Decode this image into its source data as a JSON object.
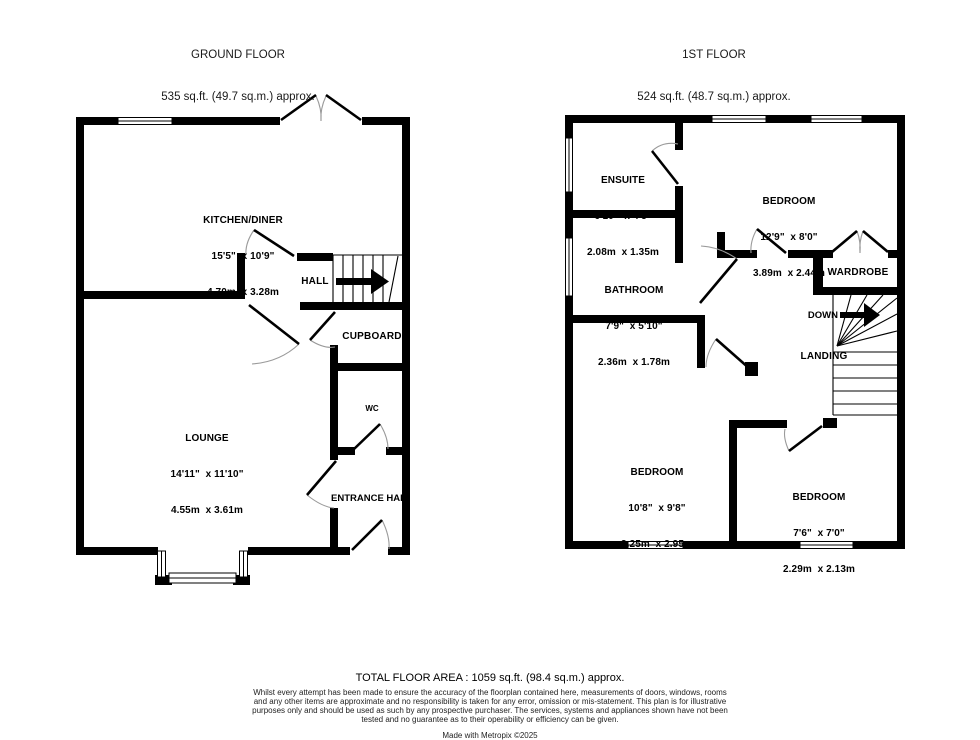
{
  "ground_floor": {
    "title": "GROUND FLOOR",
    "area": "535 sq.ft. (49.7 sq.m.) approx.",
    "kitchen": {
      "name": "KITCHEN/DINER",
      "imperial": "15'5\"  x 10'9\"",
      "metric": "4.70m  x 3.28m"
    },
    "lounge": {
      "name": "LOUNGE",
      "imperial": "14'11\"  x 11'10\"",
      "metric": "4.55m  x 3.61m"
    },
    "hall": "HALL",
    "cupboard": "CUPBOARD",
    "wc": "WC",
    "entrance_hall": "ENTRANCE HALL"
  },
  "first_floor": {
    "title": "1ST FLOOR",
    "area": "524 sq.ft. (48.7 sq.m.) approx.",
    "ensuite": {
      "name": "ENSUITE",
      "imperial": "6'10\"  x 4'5\"",
      "metric": "2.08m  x 1.35m"
    },
    "bedroom1": {
      "name": "BEDROOM",
      "imperial": "12'9\"  x 8'0\"",
      "metric": "3.89m  x 2.44m"
    },
    "bathroom": {
      "name": "BATHROOM",
      "imperial": "7'9\"  x 5'10\"",
      "metric": "2.36m  x 1.78m"
    },
    "bedroom2": {
      "name": "BEDROOM",
      "imperial": "10'8\"  x 9'8\"",
      "metric": "3.25m  x 2.95m"
    },
    "bedroom3": {
      "name": "BEDROOM",
      "imperial": "7'6\"  x 7'0\"",
      "metric": "2.29m  x 2.13m"
    },
    "wardrobe": "WARDROBE",
    "landing": "LANDING",
    "down": "DOWN"
  },
  "footer": {
    "total_area": "TOTAL FLOOR AREA : 1059 sq.ft. (98.4 sq.m.) approx.",
    "disclaimer": "Whilst every attempt has been made to ensure the accuracy of the floorplan contained here, measurements of doors, windows, rooms and any other items are approximate and no responsibility is taken for any error, omission or mis-statement. This plan is for illustrative purposes only and should be used as such by any prospective purchaser. The services, systems and appliances shown have not been tested and no guarantee as to their operability or efficiency can be given.",
    "credit": "Made with Metropix ©2025"
  },
  "colors": {
    "wall": "#000000",
    "door_arc": "#9a9a9a",
    "background": "#ffffff"
  }
}
